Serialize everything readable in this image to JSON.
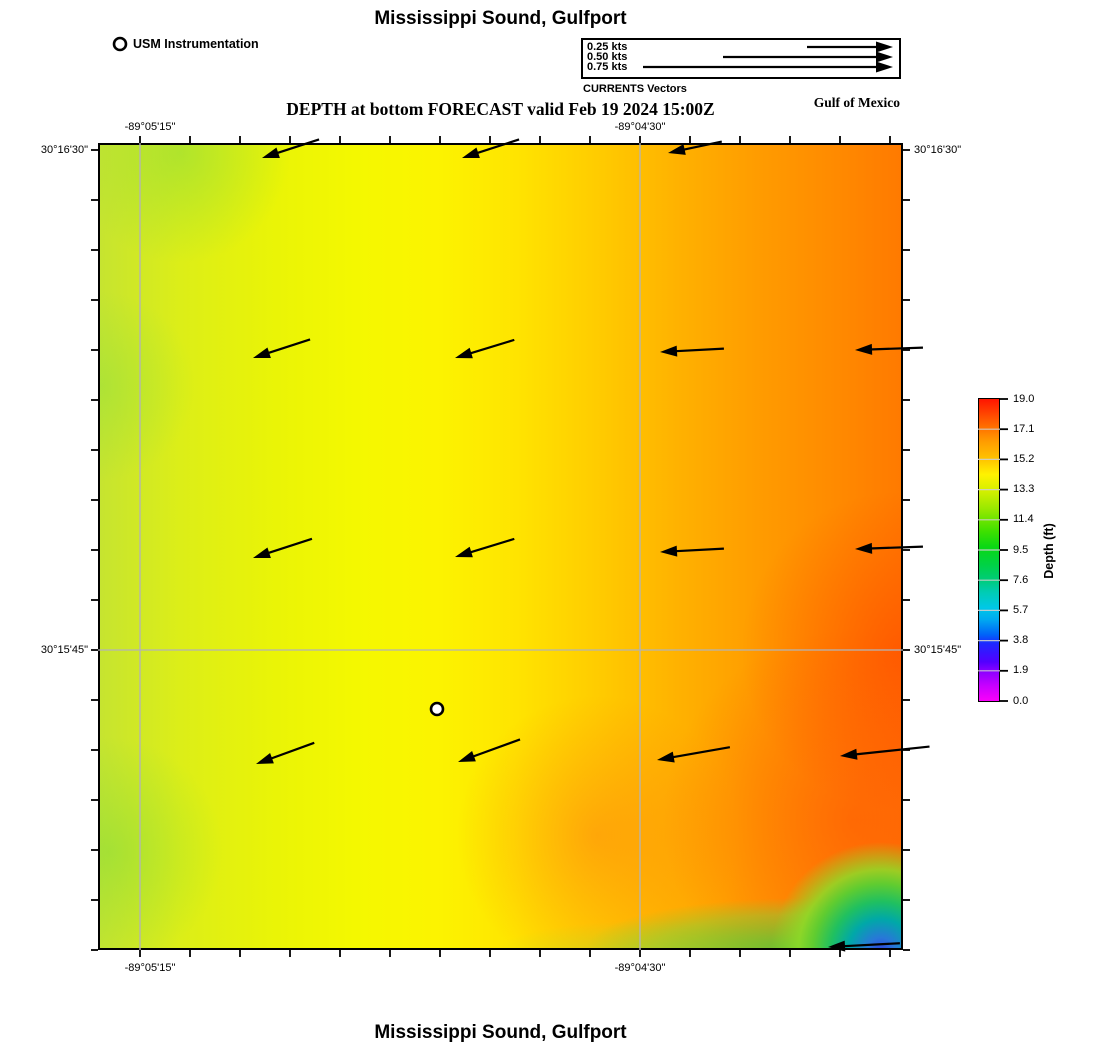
{
  "header": {
    "title": "Mississippi Sound, Gulfport",
    "subtitle": "DEPTH at bottom FORECAST valid Feb 19 2024 15:00Z",
    "region_label": "Gulf of Mexico",
    "station_legend": "USM Instrumentation",
    "vector_legend": {
      "caption": "CURRENTS Vectors",
      "items": [
        {
          "label": "0.25 kts",
          "length": 86
        },
        {
          "label": "0.50 kts",
          "length": 170
        },
        {
          "label": "0.75 kts",
          "length": 250
        }
      ]
    }
  },
  "footer": {
    "title": "Mississippi Sound, Gulfport"
  },
  "axes": {
    "top": [
      {
        "text": "-89°05'15\"",
        "x": 150
      },
      {
        "text": "-89°04'30\"",
        "x": 640
      }
    ],
    "bottom": [
      {
        "text": "-89°05'15\"",
        "x": 150
      },
      {
        "text": "-89°04'30\"",
        "x": 640
      }
    ],
    "left": [
      {
        "text": "30°16'30\"",
        "y": 150
      },
      {
        "text": "30°15'45\"",
        "y": 650
      }
    ],
    "right": [
      {
        "text": "30°16'30\"",
        "y": 150
      },
      {
        "text": "30°15'45\"",
        "y": 650
      }
    ]
  },
  "colorbar": {
    "label": "Depth (ft)",
    "ticks": [
      "19.0",
      "17.1",
      "15.2",
      "13.3",
      "11.4",
      "9.5",
      "7.6",
      "5.7",
      "3.8",
      "1.9",
      "0.0"
    ],
    "min": 0.0,
    "max": 19.0
  },
  "chart_data": {
    "type": "heatmap",
    "title": "Mississippi Sound, Gulfport",
    "subtitle": "DEPTH at bottom FORECAST valid Feb 19 2024 15:00Z",
    "valid_time": "Feb 19 2024 15:00Z",
    "variable": "Depth at bottom (ft)",
    "x_tick_labels": [
      "-89°05'15\"",
      "-89°04'30\""
    ],
    "y_tick_labels": [
      "30°16'30\"",
      "30°15'45\""
    ],
    "value_range": [
      0.0,
      19.0
    ],
    "colorbar_tick_values": [
      19.0,
      17.1,
      15.2,
      13.3,
      11.4,
      9.5,
      7.6,
      5.7,
      3.8,
      1.9,
      0.0
    ],
    "colorbar_colors": [
      "#ff1400",
      "#ff9c00",
      "#fff200",
      "#92e800",
      "#3ce000",
      "#00d246",
      "#00ccb4",
      "#00aaf0",
      "#1e28ff",
      "#8800ff",
      "#fa00fa"
    ],
    "description": "Depth ~13-15 ft (yellow-green) in west grading to ~17-19 ft (orange-red) in east; shallow green-blue pocket at southeast corner; westward current vectors",
    "plot": {
      "left": 98,
      "top": 143,
      "right": 903,
      "bottom": 950
    },
    "grid": {
      "v": [
        140,
        640
      ],
      "h": [
        650
      ]
    },
    "ticks": {
      "x0": 140,
      "x1": 890,
      "y0": 150,
      "y1": 950,
      "step": 50,
      "len": 7
    },
    "station": {
      "name": "USM Instrumentation",
      "x": 437,
      "y": 709
    },
    "legend_marker": {
      "x": 120,
      "y": 44
    },
    "legend_arrow_tip_x": 893,
    "legend_arrow_y0": 47,
    "legend_arrow_dy": 10,
    "vectors": [
      {
        "x": 262,
        "y": 158,
        "len": 60,
        "ang": 162
      },
      {
        "x": 462,
        "y": 158,
        "len": 60,
        "ang": 162
      },
      {
        "x": 668,
        "y": 153,
        "len": 55,
        "ang": 168
      },
      {
        "x": 253,
        "y": 358,
        "len": 60,
        "ang": 162
      },
      {
        "x": 455,
        "y": 358,
        "len": 62,
        "ang": 163
      },
      {
        "x": 660,
        "y": 352,
        "len": 64,
        "ang": 177
      },
      {
        "x": 855,
        "y": 350,
        "len": 68,
        "ang": 178
      },
      {
        "x": 253,
        "y": 558,
        "len": 62,
        "ang": 162
      },
      {
        "x": 455,
        "y": 557,
        "len": 62,
        "ang": 163
      },
      {
        "x": 660,
        "y": 552,
        "len": 64,
        "ang": 177
      },
      {
        "x": 855,
        "y": 549,
        "len": 68,
        "ang": 178
      },
      {
        "x": 256,
        "y": 764,
        "len": 62,
        "ang": 160
      },
      {
        "x": 458,
        "y": 762,
        "len": 66,
        "ang": 160
      },
      {
        "x": 657,
        "y": 760,
        "len": 74,
        "ang": 170
      },
      {
        "x": 840,
        "y": 756,
        "len": 90,
        "ang": 174
      },
      {
        "x": 828,
        "y": 947,
        "len": 72,
        "ang": 177
      }
    ],
    "colorbar_geom": {
      "left": 978,
      "top": 399,
      "width": 22,
      "height": 302
    }
  }
}
